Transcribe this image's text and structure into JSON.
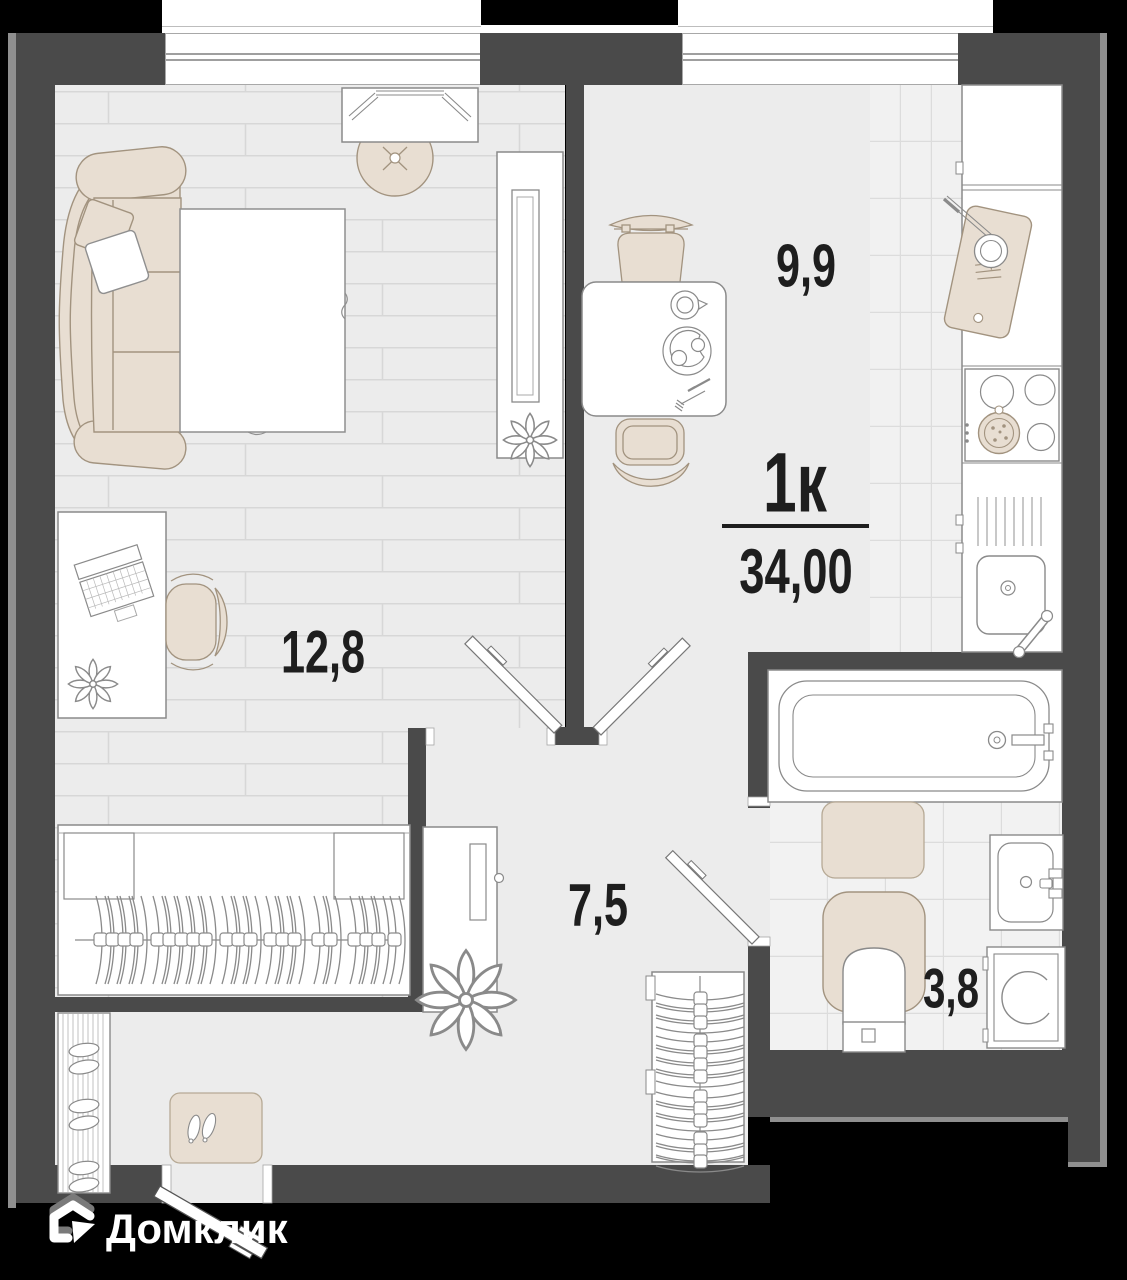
{
  "plan": {
    "summary": {
      "rooms_label": "1к",
      "total_area": "34,00"
    },
    "rooms": {
      "kitchen": {
        "area": "9,9"
      },
      "living": {
        "area": "12,8"
      },
      "hallway": {
        "area": "7,5"
      },
      "bathroom": {
        "area": "3,8"
      }
    }
  },
  "branding": {
    "logo_text": "Домклик",
    "logo_icon": "domclick-house-icon"
  },
  "colors": {
    "background": "#000000",
    "wall": "#4a4a4a",
    "wall_edge": "#8f8f8f",
    "floor": "#ececec",
    "tile": "#f1f1f1",
    "furniture_beige": "#e8ded2",
    "label_text": "#1e1e1e",
    "logo": "#ffffff"
  }
}
